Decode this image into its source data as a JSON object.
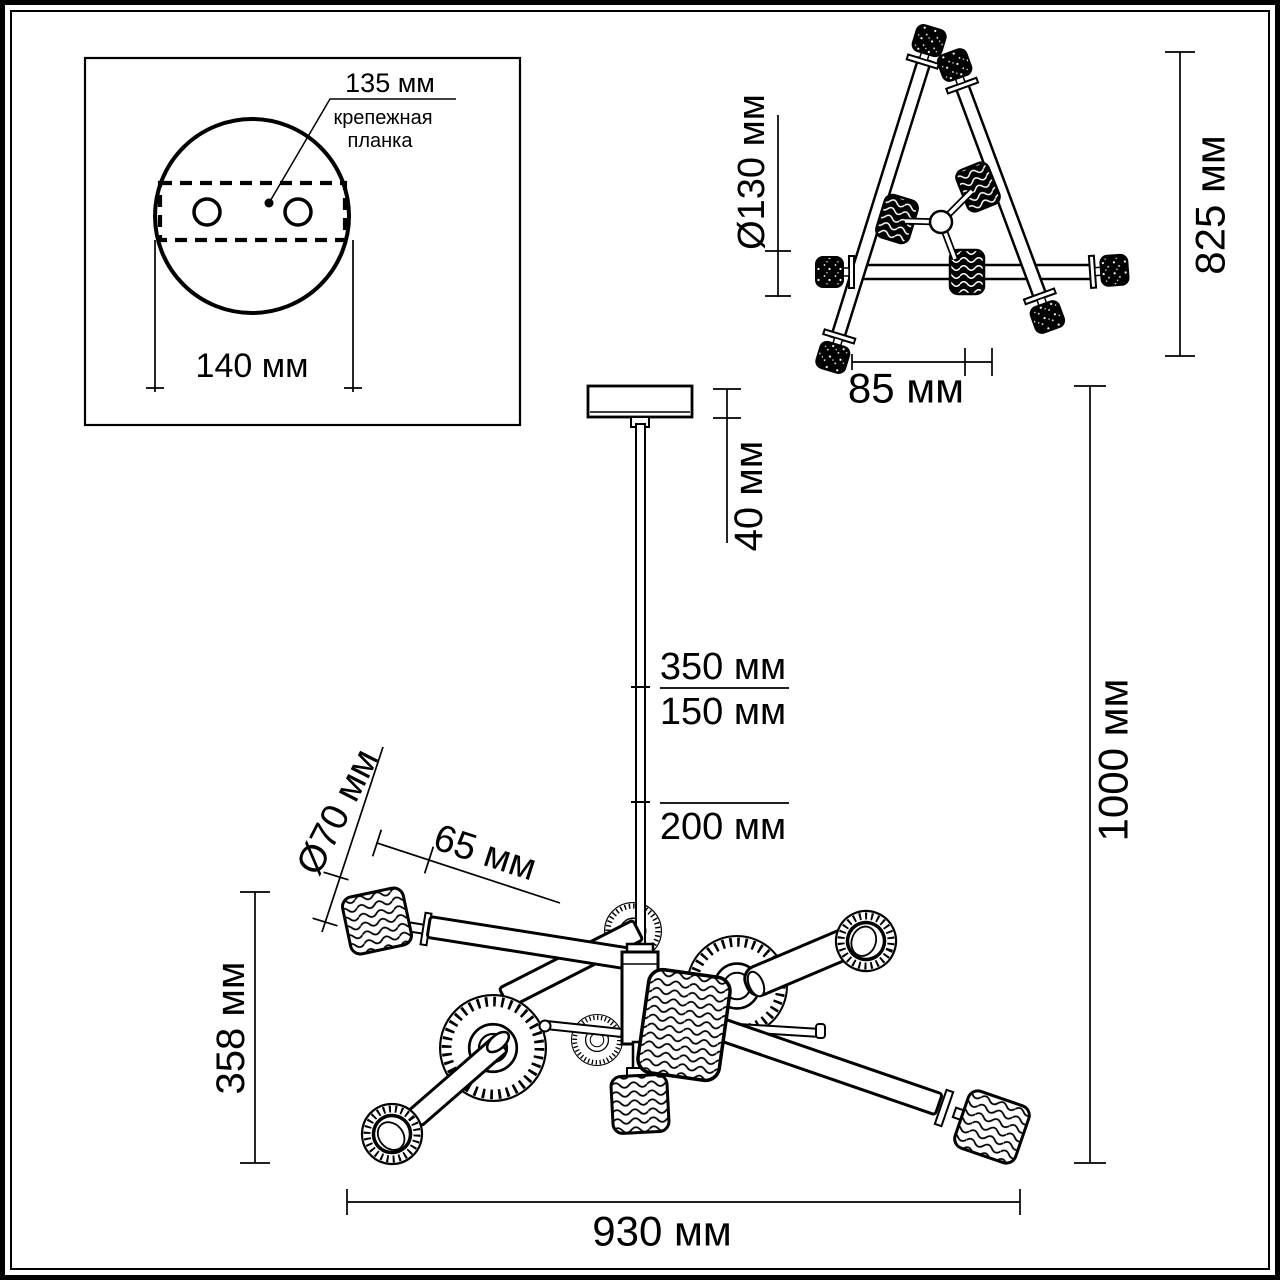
{
  "drawing": {
    "kind": "chandelier dimension diagram",
    "units": "мм",
    "ink_color": "#000000",
    "background_color": "#ffffff",
    "mount_view": {
      "hole_spacing_label": "135 мм",
      "plate_label_line1": "крепежная",
      "plate_label_line2": "планка",
      "canopy_diameter_label": "140 мм"
    },
    "top_view": {
      "center_shade_diameter_label": "Ø130 мм",
      "overall_width_label": "825 мм",
      "shade_offset_label": "85 мм"
    },
    "side_view": {
      "canopy_height_label": "40 мм",
      "rod_segment_upper_label": "350 мм",
      "rod_segment_middle_label": "150 мм",
      "rod_segment_lower_label": "200 мм",
      "shade_diameter_label": "Ø70 мм",
      "shade_length_label": "65 мм",
      "body_height_label": "358 мм",
      "overall_height_label": "1000 мм",
      "overall_width_label": "930 мм"
    }
  }
}
